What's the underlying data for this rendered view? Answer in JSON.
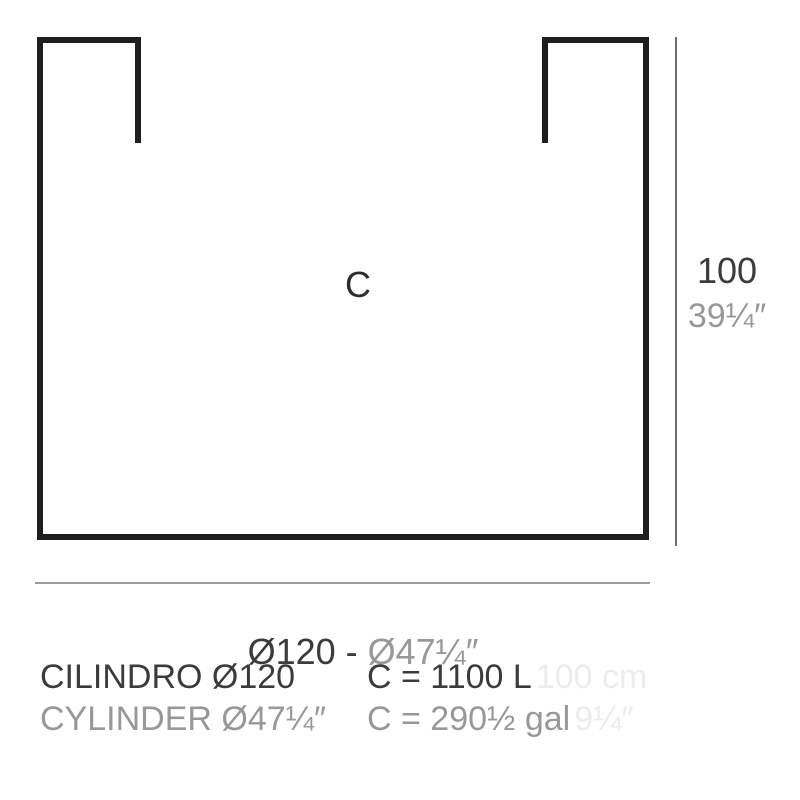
{
  "diagram": {
    "center_label": "C",
    "height": {
      "metric": "100",
      "imperial": "39¼″"
    },
    "diameter": {
      "metric_part": "Ø120 - ",
      "imperial_part": "Ø47¼″"
    },
    "specs": [
      {
        "name": "CILINDRO Ø120",
        "capacity": "C = 1100 L",
        "ghost": "100 cm"
      },
      {
        "name": "CYLINDER Ø47¼″",
        "capacity": "C = 290½ gal",
        "ghost": "9¼″"
      }
    ],
    "colors": {
      "outline": "#1e1e1e",
      "dark_text": "#3b3b3d",
      "gray_text": "#98989a",
      "ghost_text": "#ececec",
      "dimension_line_vertical": "#6e6e6e",
      "dimension_line_horizontal": "#9b9b9b"
    }
  }
}
